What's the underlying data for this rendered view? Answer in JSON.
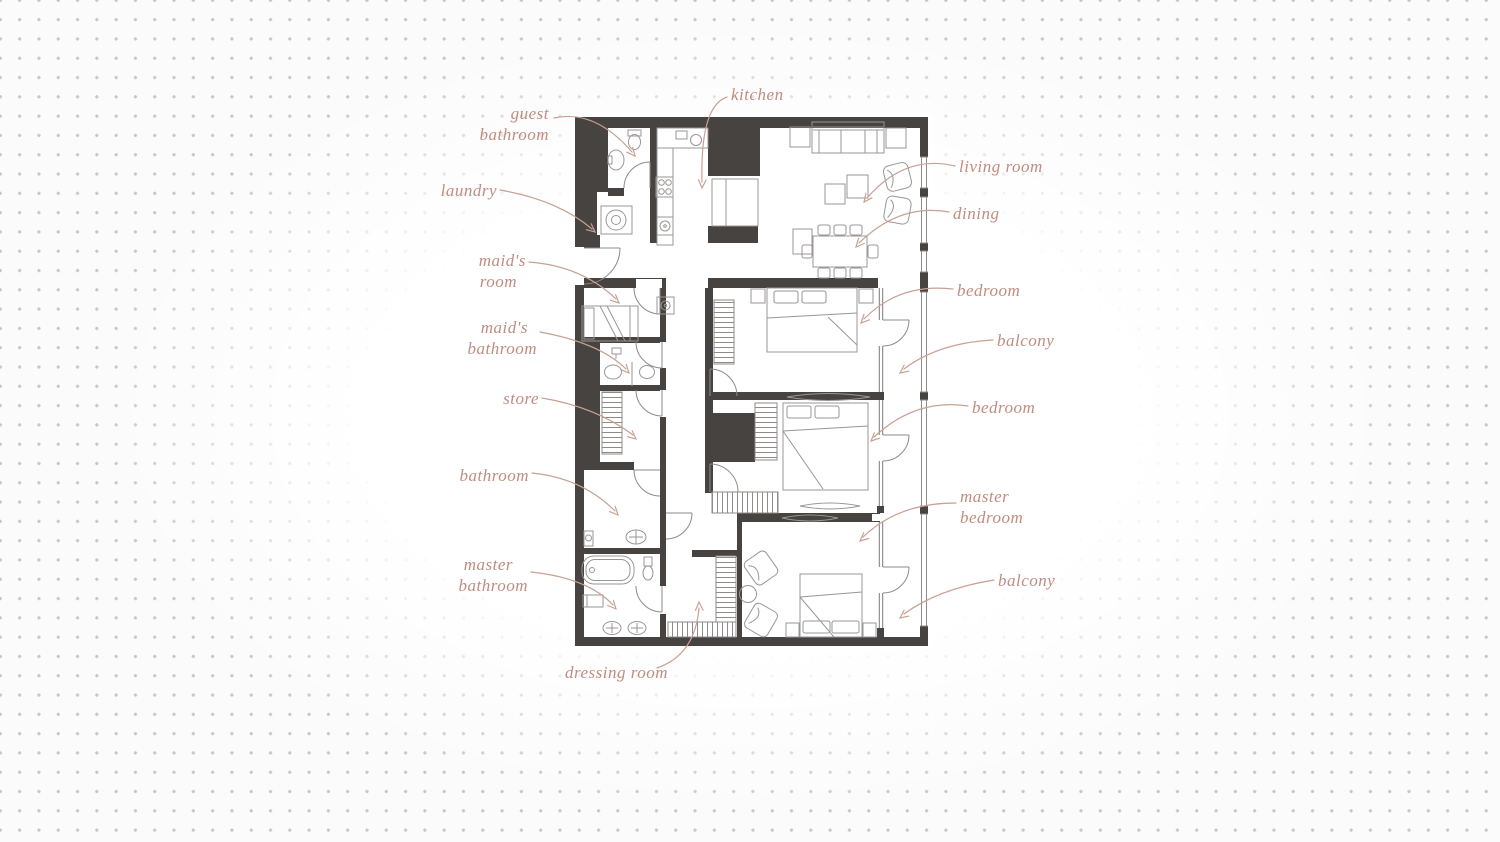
{
  "meta": {
    "title": "apartment floor plan",
    "accent_color": "#bf8c80",
    "wall_color": "#474340",
    "dot_color": "#c7c7cb"
  },
  "plan": {
    "labels": [
      {
        "id": "kitchen",
        "text": "kitchen"
      },
      {
        "id": "guest-bathroom",
        "line1": "guest",
        "line2": "bathroom"
      },
      {
        "id": "laundry",
        "text": "laundry"
      },
      {
        "id": "maids-room",
        "line1": "maid's",
        "line2": "room"
      },
      {
        "id": "maids-bathroom",
        "line1": "maid's",
        "line2": "bathroom"
      },
      {
        "id": "store",
        "text": "store"
      },
      {
        "id": "bathroom",
        "text": "bathroom"
      },
      {
        "id": "master-bathroom",
        "line1": "master",
        "line2": "bathroom"
      },
      {
        "id": "dressing-room",
        "text": "dressing room"
      },
      {
        "id": "living-room",
        "text": "living room"
      },
      {
        "id": "dining",
        "text": "dining"
      },
      {
        "id": "bedroom-1",
        "text": "bedroom"
      },
      {
        "id": "balcony-1",
        "text": "balcony"
      },
      {
        "id": "bedroom-2",
        "text": "bedroom"
      },
      {
        "id": "master-bedroom",
        "line1": "master",
        "line2": "bedroom"
      },
      {
        "id": "balcony-2",
        "text": "balcony"
      }
    ]
  }
}
